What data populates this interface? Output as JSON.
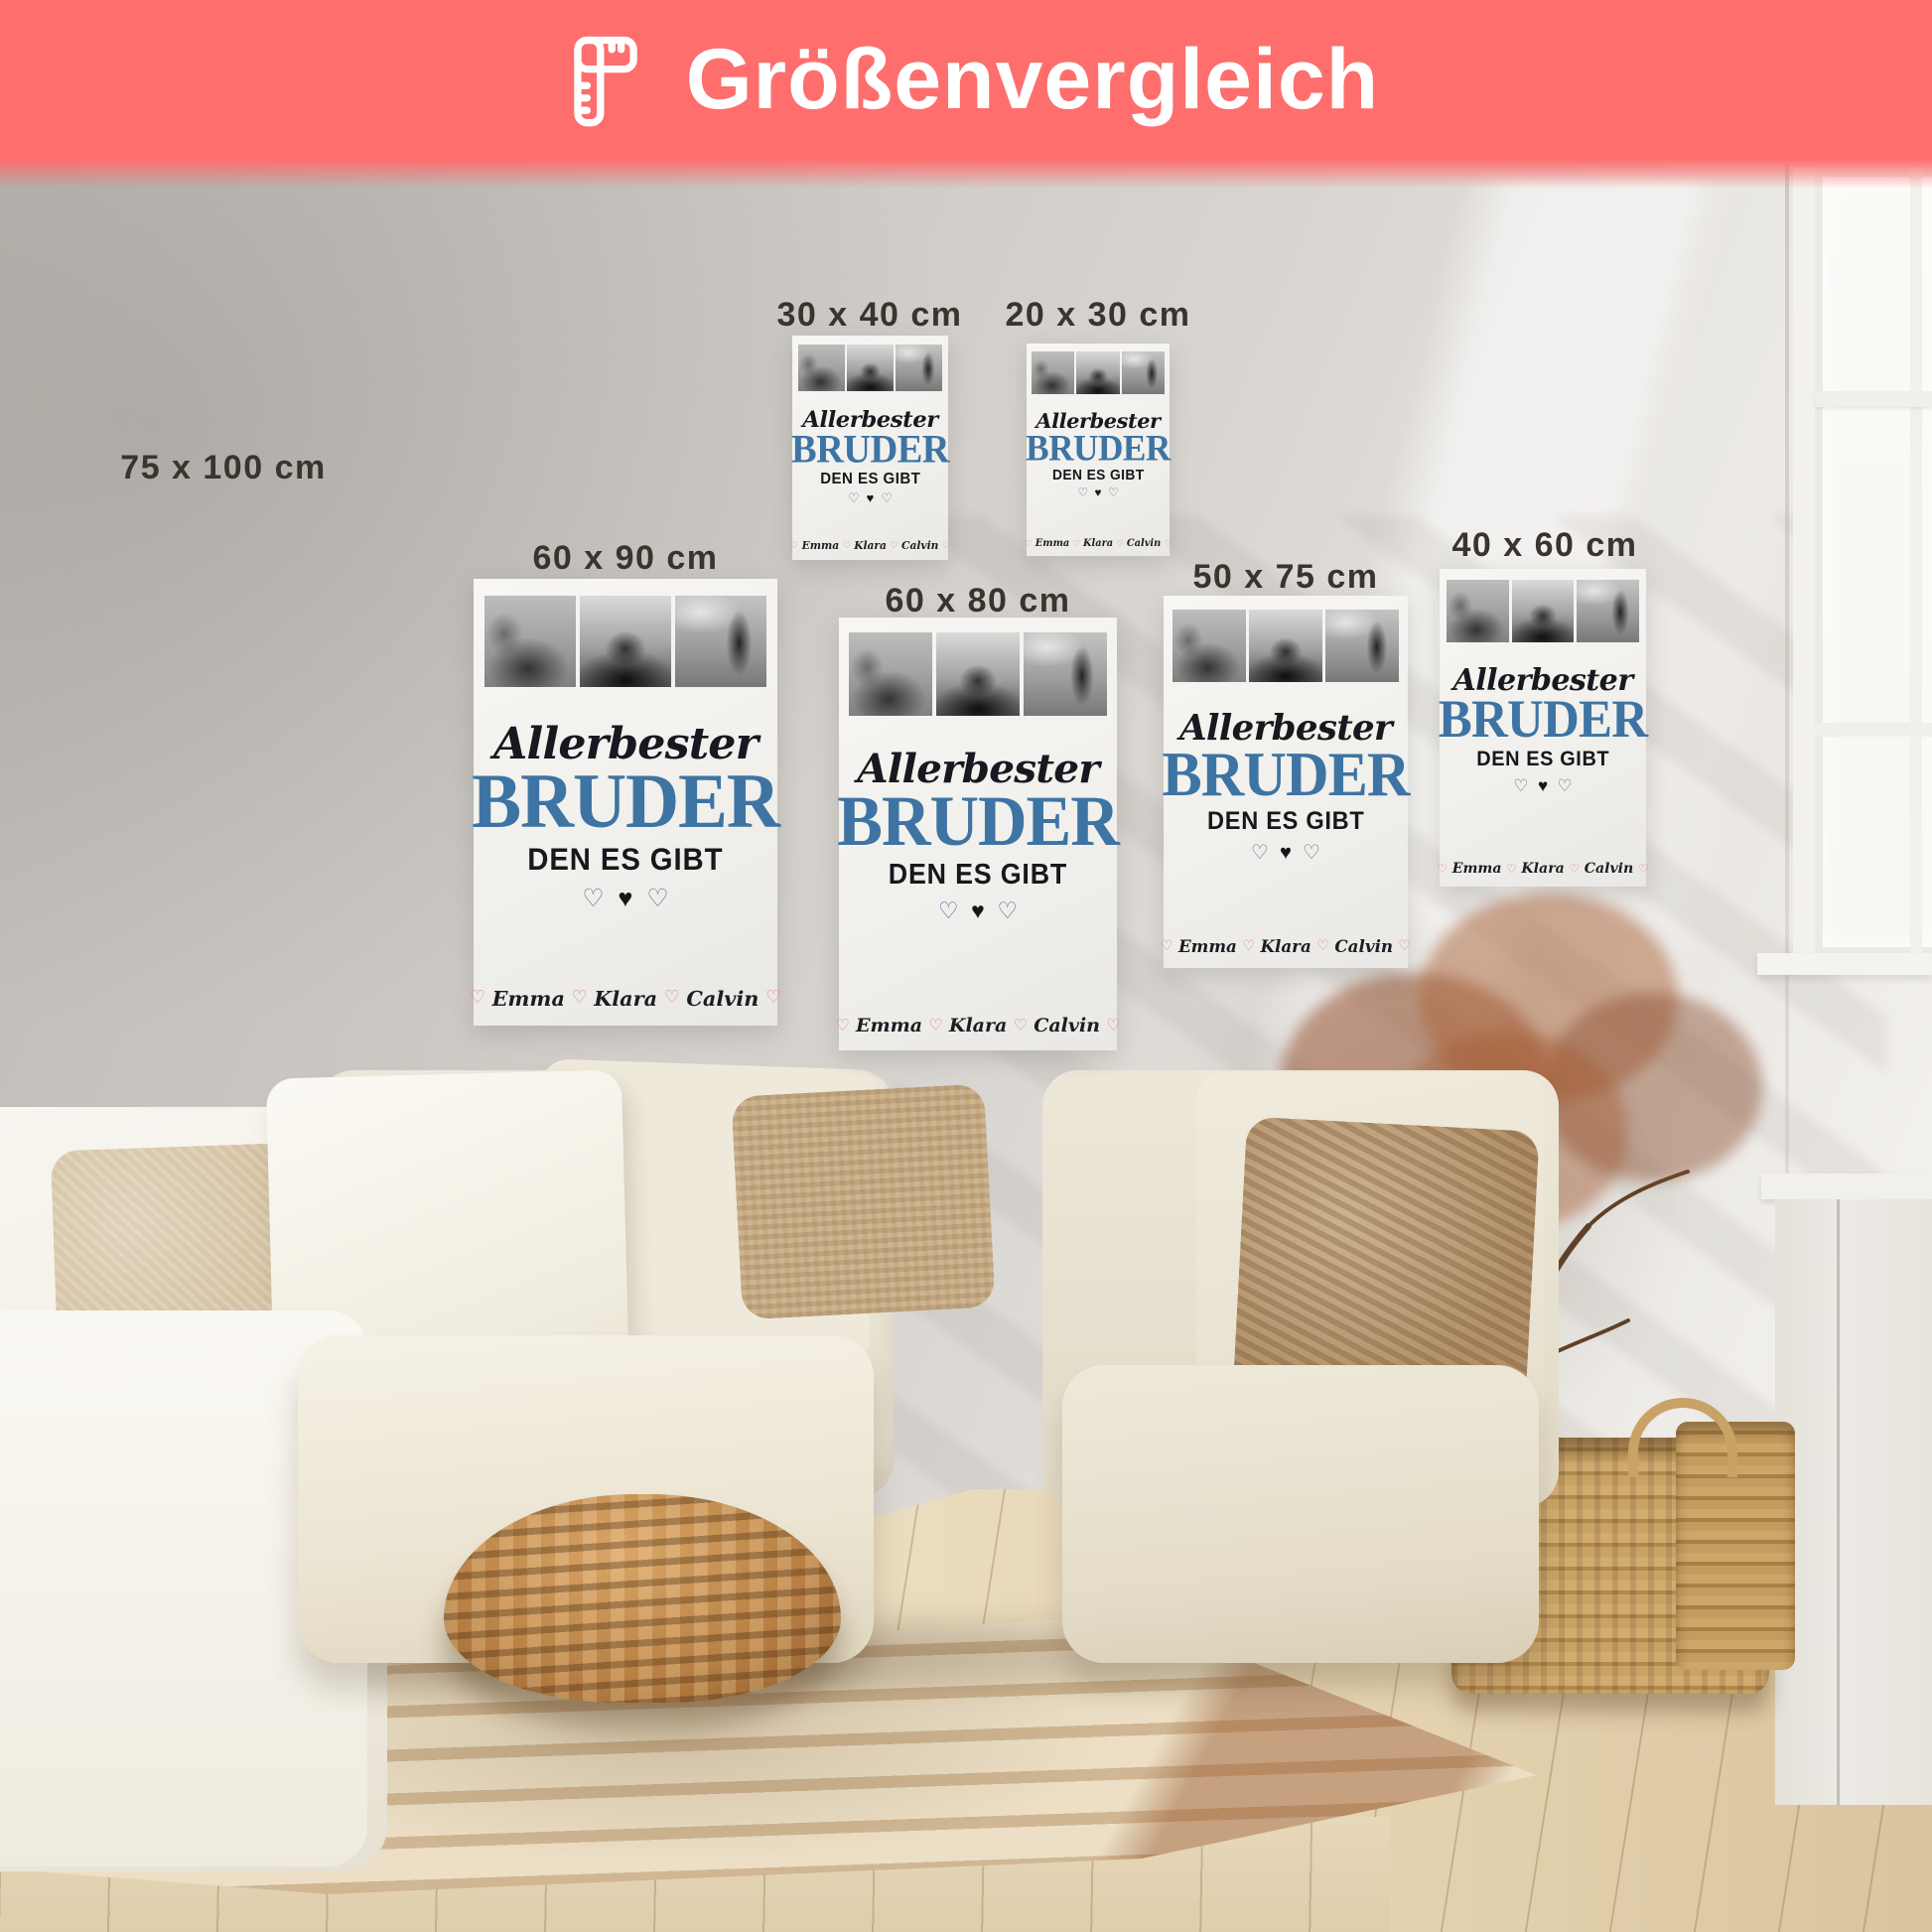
{
  "header": {
    "title": "Größenvergleich",
    "background_color": "#fd6e6d",
    "text_color": "#ffffff",
    "icon": "ruler-icon"
  },
  "sizes": [
    {
      "label": "75 x 100 cm",
      "has_poster": false
    },
    {
      "label": "30 x 40 cm",
      "has_poster": true
    },
    {
      "label": "20 x 30 cm",
      "has_poster": true
    },
    {
      "label": "60 x 90 cm",
      "has_poster": true
    },
    {
      "label": "60 x 80 cm",
      "has_poster": true
    },
    {
      "label": "50 x 75 cm",
      "has_poster": true
    },
    {
      "label": "40 x 60 cm",
      "has_poster": true
    }
  ],
  "poster_design": {
    "script_title": "Allerbester",
    "main_title": "BRUDER",
    "subtitle": "DEN ES GIBT",
    "names": [
      "Emma",
      "Klara",
      "Calvin"
    ],
    "outline_heart_glyph": "♡",
    "solid_heart_glyph": "♥",
    "names_heart_glyph": "♡",
    "main_title_color": "#3e74a3",
    "outline_heart_color": "#4d7ba4",
    "solid_heart_color": "#15151a",
    "names_heart_color": "#e8827c"
  },
  "photos": [
    "family-sitting-photo",
    "family-silhouette-sunset-photo",
    "father-child-lake-photo"
  ]
}
